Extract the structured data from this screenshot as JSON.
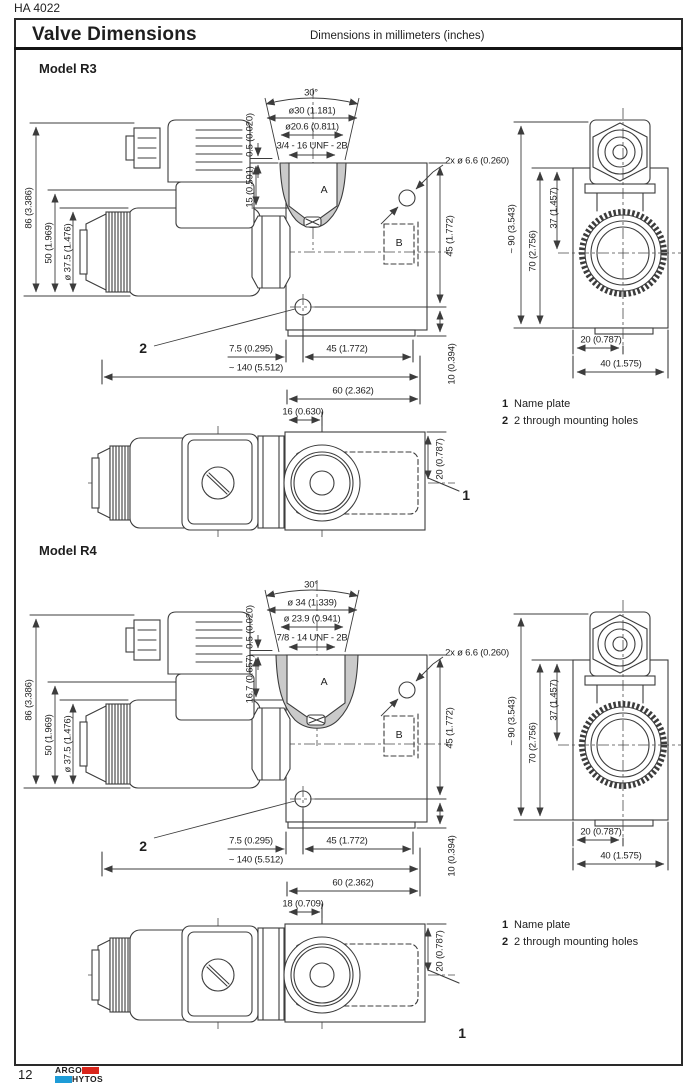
{
  "doc_code": "HA 4022",
  "page_number": "12",
  "header": {
    "title": "Valve Dimensions",
    "subtitle": "Dimensions in millimeters (inches)"
  },
  "logo": {
    "top_text": "ARGO",
    "bottom_text": "HYTOS",
    "red": "#d9261c",
    "blue": "#1e9cd7"
  },
  "legend": {
    "items": [
      {
        "num": "1",
        "text": "Name plate"
      },
      {
        "num": "2",
        "text": "2 through mounting holes"
      }
    ]
  },
  "models": {
    "r3": {
      "heading": "Model R3",
      "dims": {
        "angle": "30°",
        "dia_outer": "ø30 (1.181)",
        "dia_inner": "ø20.6 (0.811)",
        "thread": "3/4 - 16 UNF - 2B",
        "depth_small": "0.5 (0.020)",
        "port_depth": "15 (0.591)",
        "port_a": "A",
        "port_b": "B",
        "mount_holes": "2x ø 6.6 (0.260)",
        "height_45": "45 (1.772)",
        "overall_height": "86 (3.386)",
        "coil_height": "50 (1.969)",
        "coil_dia": "ø 37.5 (1.476)",
        "hole_offset": "7.5 (0.295)",
        "width_45": "45 (1.772)",
        "overall_length": "~ 140 (5.512)",
        "base_height": "10 (0.394)",
        "body_length": "60 (2.362)",
        "port_offset": "16 (0.630)",
        "port_center": "20 (0.787)",
        "callout_1": "1",
        "callout_2": "2",
        "ev_overall": "~ 90 (3.543)",
        "ev_height_70": "70 (2.756)",
        "ev_height_37": "37 (1.457)",
        "ev_width_20": "20 (0.787)",
        "ev_width_40": "40 (1.575)"
      }
    },
    "r4": {
      "heading": "Model R4",
      "dims": {
        "angle": "30°",
        "dia_outer": "ø 34 (1.339)",
        "dia_inner": "ø 23.9 (0.941)",
        "thread": "7/8 - 14 UNF - 2B",
        "depth_small": "0.5 (0.020)",
        "port_depth": "16.7 (0.657)",
        "port_a": "A",
        "port_b": "B",
        "mount_holes": "2x ø 6.6 (0.260)",
        "height_45": "45 (1.772)",
        "overall_height": "86 (3.386)",
        "coil_height": "50 (1.969)",
        "coil_dia": "ø 37.5 (1.476)",
        "hole_offset": "7.5 (0.295)",
        "width_45": "45 (1.772)",
        "overall_length": "~ 140 (5.512)",
        "base_height": "10 (0.394)",
        "body_length": "60 (2.362)",
        "port_offset": "18 (0.709)",
        "port_center": "20 (0.787)",
        "callout_1": "1",
        "callout_2": "2",
        "ev_overall": "~ 90 (3.543)",
        "ev_height_70": "70 (2.756)",
        "ev_height_37": "37 (1.457)",
        "ev_width_20": "20 (0.787)",
        "ev_width_40": "40 (1.575)"
      }
    }
  }
}
